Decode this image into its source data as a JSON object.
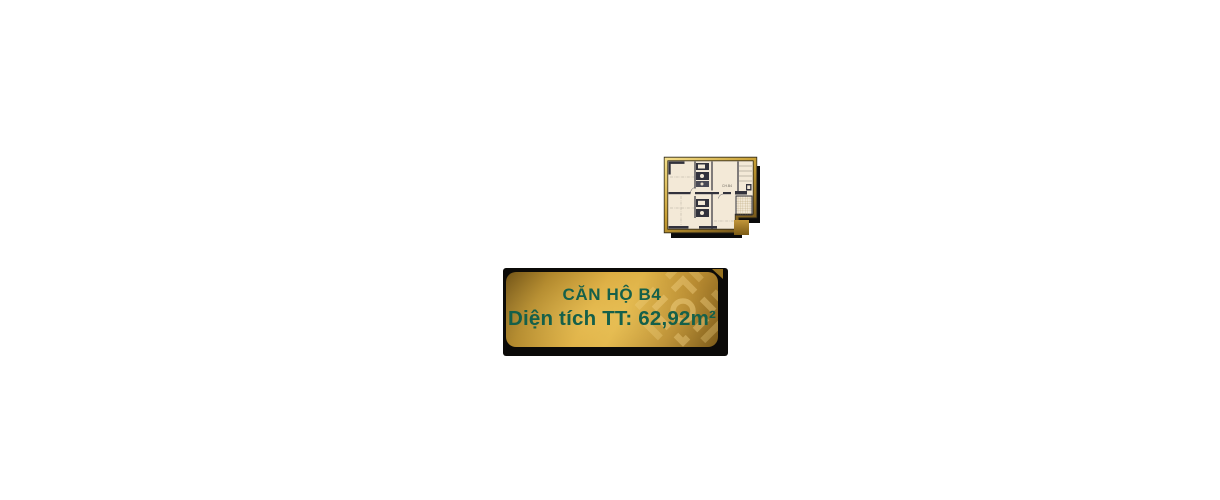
{
  "page": {
    "background_color": "#ffffff",
    "width": 1220,
    "height": 500
  },
  "floorplan": {
    "unit_label": "CH.B4",
    "colors": {
      "border_gold_light": "#f4de8a",
      "border_gold_dark": "#76571a",
      "floor": "#f3e9d7",
      "walls": "#32323c",
      "shadow": "#0b0b0b",
      "accent_square": "#b78b28"
    }
  },
  "label_card": {
    "title": "CĂN HỘ B4",
    "area_line": "Diện tích TT: 62,92m²",
    "colors": {
      "text_green": "#15604a",
      "gold_bright": "#d9a93e",
      "gold_dark": "#6e5015",
      "backdrop_black": "#0b0a08",
      "emblem_gold": "#f2d282"
    }
  }
}
